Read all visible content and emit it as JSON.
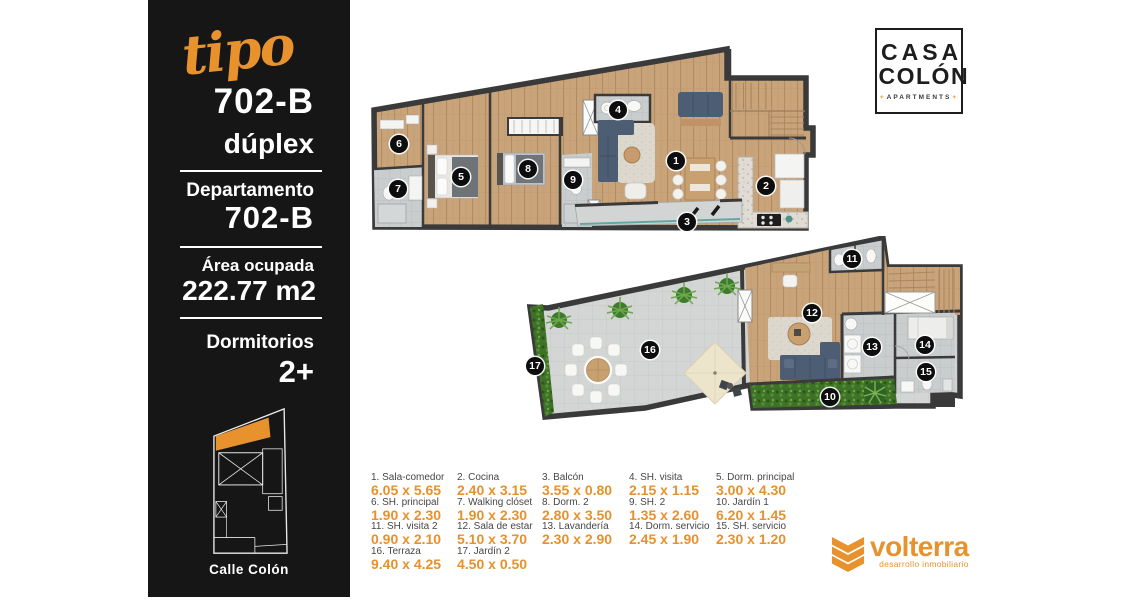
{
  "sidebar": {
    "script_word": "tipo",
    "unit_number": "702-B",
    "unit_type": "dúplex",
    "department_label": "Departamento",
    "department_value": "702-B",
    "area_label": "Área ocupada",
    "area_value": "222.77 m2",
    "bedrooms_label": "Dormitorios",
    "bedrooms_value": "2+",
    "street_label": "Calle Colón"
  },
  "logo_casa_colon": {
    "line1": "CASA",
    "line2": "COLÓN",
    "plus": "+",
    "apartments": "APARTMENTS"
  },
  "logo_volterra": {
    "name": "volterra",
    "tagline": "desarrollo inmobiliario"
  },
  "markers": [
    "1",
    "2",
    "3",
    "4",
    "5",
    "6",
    "7",
    "8",
    "9",
    "10",
    "11",
    "12",
    "13",
    "14",
    "15",
    "16",
    "17"
  ],
  "legend": {
    "items": [
      {
        "label": "1. Sala-comedor",
        "dim": "6.05 x 5.65"
      },
      {
        "label": "2. Cocina",
        "dim": "2.40 x 3.15"
      },
      {
        "label": "3. Balcón",
        "dim": "3.55 x 0.80"
      },
      {
        "label": "4. SH. visita",
        "dim": "2.15 x 1.15"
      },
      {
        "label": "5. Dorm. principal",
        "dim": "3.00 x 4.30"
      },
      {
        "label": "6. SH. principal",
        "dim": "1.90 x 2.30"
      },
      {
        "label": "7. Walking clóset",
        "dim": "1.90 x 2.30"
      },
      {
        "label": "8. Dorm. 2",
        "dim": "2.80 x 3.50"
      },
      {
        "label": "9. SH. 2",
        "dim": "1.35 x 2.60"
      },
      {
        "label": "10. Jardín 1",
        "dim": "6.20 x 1.45"
      },
      {
        "label": "11. SH. visita 2",
        "dim": "0.90 x 2.10"
      },
      {
        "label": "12. Sala de estar",
        "dim": "5.10 x 3.70"
      },
      {
        "label": "13. Lavandería",
        "dim": "2.30 x 2.90"
      },
      {
        "label": "14. Dorm. servicio",
        "dim": "2.45 x 1.90"
      },
      {
        "label": "15. SH. servicio",
        "dim": "2.30 x 1.20"
      },
      {
        "label": "16. Terraza",
        "dim": "9.40 x 4.25"
      },
      {
        "label": "17. Jardín 2",
        "dim": "4.50 x 0.50"
      }
    ]
  },
  "colors": {
    "accent_orange": "#E8922E",
    "panel_black": "#161616",
    "wall_dark": "#3A3A3A"
  }
}
